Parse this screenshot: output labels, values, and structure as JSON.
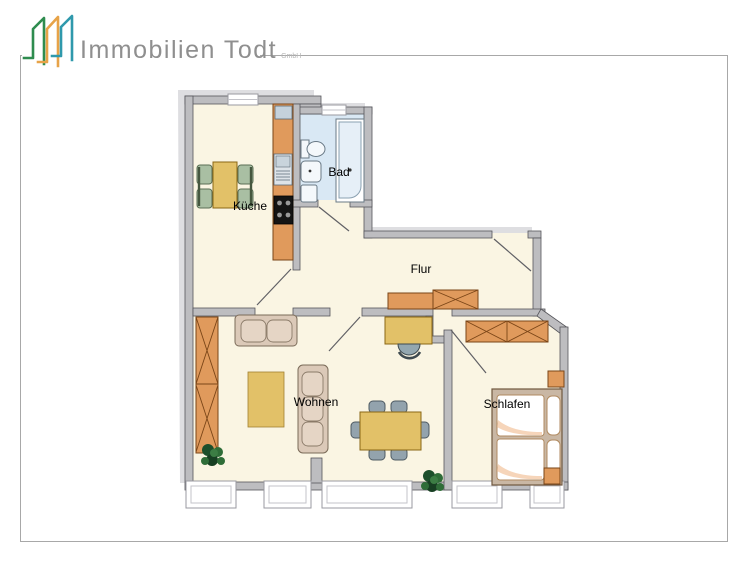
{
  "page": {
    "background": "#ffffff",
    "frame_border": "#a8a8a8"
  },
  "logo": {
    "company": "Immobilien Todt",
    "suffix": "GmbH",
    "house_colors": [
      "#2e8c4f",
      "#e7a348",
      "#2f99ac"
    ],
    "text_color": "#8f8f8f"
  },
  "floorplan": {
    "rooms": [
      {
        "id": "kueche",
        "label": "Küche"
      },
      {
        "id": "bad",
        "label": "Bad"
      },
      {
        "id": "flur",
        "label": "Flur"
      },
      {
        "id": "wohnen",
        "label": "Wohnen"
      },
      {
        "id": "schlafen",
        "label": "Schlafen"
      }
    ],
    "colors": {
      "wall": "#bdbdc0",
      "wall_edge": "#55555a",
      "floor": "#faf5e3",
      "bath_floor": "#d9e8f4",
      "shadow": "#dedee1",
      "wood_orange": "#e09a5c",
      "wood_edge": "#7a4517",
      "table_yellow": "#e2c168",
      "chair_green": "#a9bfa3",
      "chair_gray": "#93a7b0",
      "sofa_beige": "#dbc9b8",
      "plant_green": "#1d4f2b",
      "stove_black": "#141414"
    }
  }
}
